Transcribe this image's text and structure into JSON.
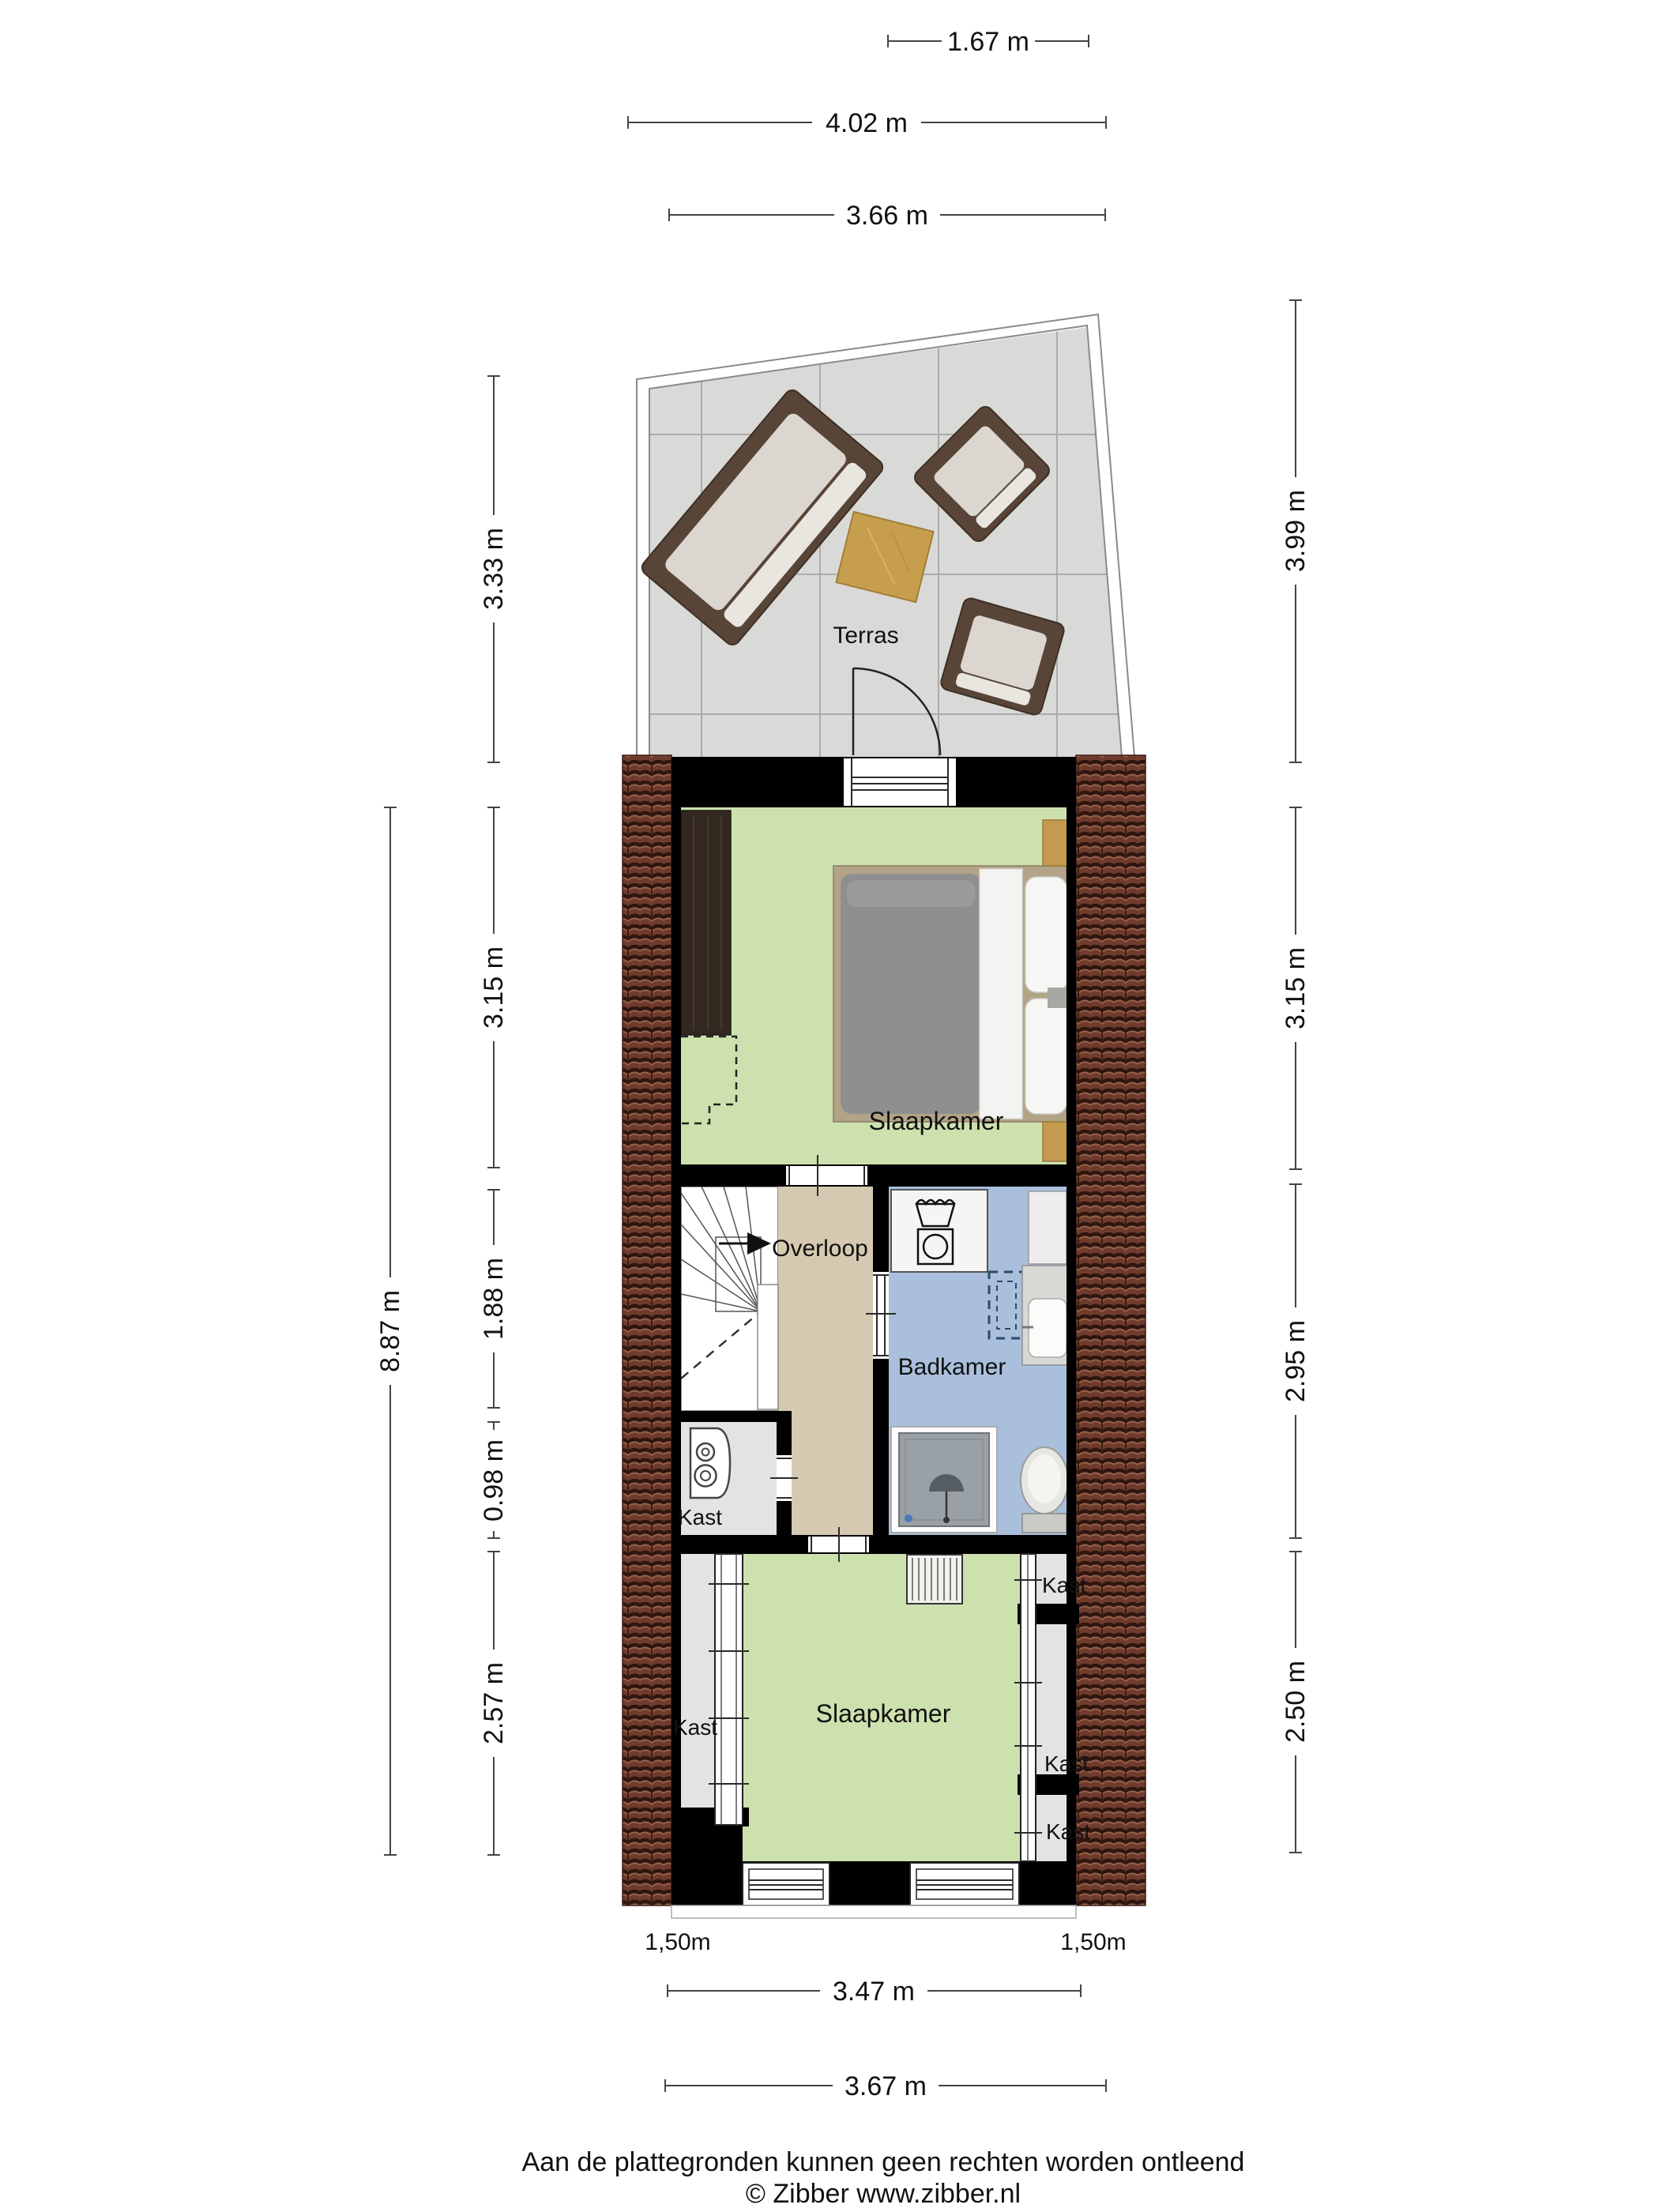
{
  "colors": {
    "wall": "#000000",
    "roof_tile": "#6f3b2c",
    "roof_tile_joint": "#2e1610",
    "roof_tile_highlight": "#96604b",
    "terras_floor": "#d9d9d7",
    "terras_grid": "#ababa9",
    "bedroom_floor": "#cde1ae",
    "landing_floor": "#d6c9b2",
    "bathroom_floor": "#a9bfdc",
    "closet_floor": "#e3e3e1",
    "dim_line": "#444444",
    "label_text": "#111111",
    "wood_dark": "#332820",
    "bed_duvet": "#8f8f8f",
    "nightstand_wood": "#c49b4e",
    "outdoor_frame": "#584538",
    "outdoor_cushion": "#dbd7d0",
    "table_wood": "#c79e4e",
    "fixture_gray": "#9aa1a6"
  },
  "dimensions": {
    "top": [
      {
        "label": "1.67 m"
      },
      {
        "label": "4.02 m"
      },
      {
        "label": "3.66 m"
      }
    ],
    "bottom": [
      {
        "label": "3.47 m"
      },
      {
        "label": "3.67 m"
      }
    ],
    "left": [
      {
        "label": "3.33 m"
      },
      {
        "label": "3.15 m"
      },
      {
        "label": "1.88 m"
      },
      {
        "label": "0.98 m"
      },
      {
        "label": "2.57 m"
      },
      {
        "label": "8.87 m"
      }
    ],
    "right": [
      {
        "label": "3.99 m"
      },
      {
        "label": "3.15 m"
      },
      {
        "label": "2.95 m"
      },
      {
        "label": "2.50 m"
      }
    ],
    "knee_wall_left": "1,50m",
    "knee_wall_right": "1,50m"
  },
  "rooms": {
    "terras": "Terras",
    "slaapkamer_boven": "Slaapkamer",
    "overloop": "Overloop",
    "badkamer": "Badkamer",
    "kast_cv": "Kast",
    "kast_links": "Kast",
    "kast_rechts_boven": "Kast",
    "kast_rechts_midden": "Kast",
    "kast_rechts_onder": "Kast",
    "slaapkamer_onder": "Slaapkamer"
  },
  "footer": {
    "disclaimer": "Aan de plattegronden kunnen geen rechten worden ontleend",
    "copyright": "© Zibber www.zibber.nl"
  }
}
